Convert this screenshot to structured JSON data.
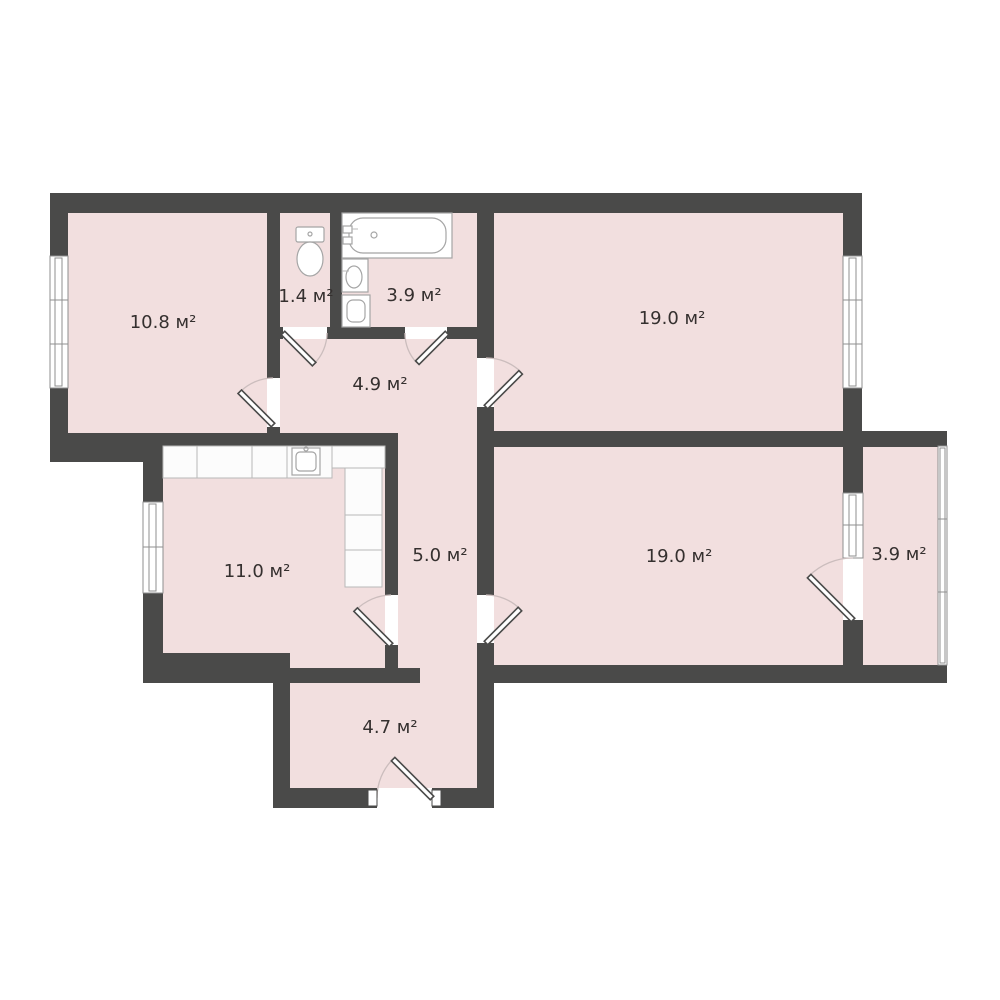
{
  "plan": {
    "background": "#ffffff",
    "unit": "м²",
    "colors": {
      "wall": "#4a4a49",
      "floor": "#f2dfdf",
      "label_text": "#35302f",
      "door_arc": "#cbbdbd",
      "window_line": "#8f8f8f"
    },
    "rooms": [
      {
        "id": "room-top-left",
        "area": "10.8",
        "label": "10.8 м²"
      },
      {
        "id": "wc",
        "area": "1.4",
        "label": "1.4 м²"
      },
      {
        "id": "bathroom",
        "area": "3.9",
        "label": "3.9 м²"
      },
      {
        "id": "room-top-right",
        "area": "19.0",
        "label": "19.0 м²"
      },
      {
        "id": "hallway",
        "area": "4.9",
        "label": "4.9 м²"
      },
      {
        "id": "kitchen",
        "area": "11.0",
        "label": "11.0 м²"
      },
      {
        "id": "corridor",
        "area": "5.0",
        "label": "5.0 м²"
      },
      {
        "id": "room-middle-right",
        "area": "19.0",
        "label": "19.0 м²"
      },
      {
        "id": "balcony",
        "area": "3.9",
        "label": "3.9 м²"
      },
      {
        "id": "entry",
        "area": "4.7",
        "label": "4.7 м²"
      }
    ],
    "fixtures": [
      "bathtub",
      "toilet",
      "bathroom-sink",
      "washing-machine",
      "kitchen-counter",
      "kitchen-sink"
    ]
  }
}
